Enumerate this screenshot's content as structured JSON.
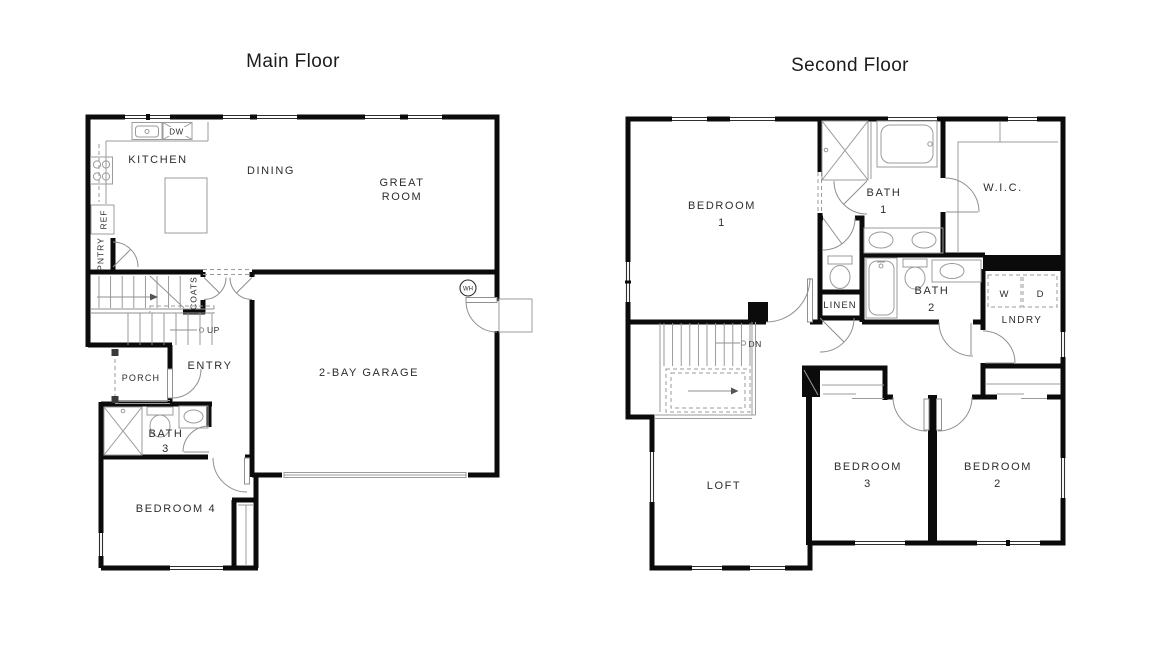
{
  "main_floor": {
    "title": "Main Floor",
    "labels": {
      "kitchen": "KITCHEN",
      "dining": "DINING",
      "great_room": [
        "GREAT",
        "ROOM"
      ],
      "garage": "2-BAY GARAGE",
      "entry": "ENTRY",
      "porch": "PORCH",
      "bath3": [
        "BATH",
        "3"
      ],
      "bedroom4": "BEDROOM 4",
      "coats": "COATS",
      "pantry": "PNTRY",
      "refrigerator": "REF",
      "dishwasher": "DW",
      "stairs_direction": "UP",
      "water_heater": "WH"
    }
  },
  "second_floor": {
    "title": "Second Floor",
    "labels": {
      "bedroom1": [
        "BEDROOM",
        "1"
      ],
      "bath1": [
        "BATH",
        "1"
      ],
      "wic": "W.I.C.",
      "linen": "LINEN",
      "bath2": [
        "BATH",
        "2"
      ],
      "laundry": "LNDRY",
      "washer": "W",
      "dryer": "D",
      "stairs_direction": "DN",
      "loft": "LOFT",
      "bedroom3": [
        "BEDROOM",
        "3"
      ],
      "bedroom2": [
        "BEDROOM",
        "2"
      ]
    }
  },
  "colors": {
    "background": "#ffffff",
    "wall": "#0b0b0b",
    "fixture_line": "#9b9b9b",
    "door_line": "#8f8f8f",
    "window_line": "#2e2e2e",
    "label_text": "#2d2d2d",
    "title_text": "#1c1c1c"
  }
}
